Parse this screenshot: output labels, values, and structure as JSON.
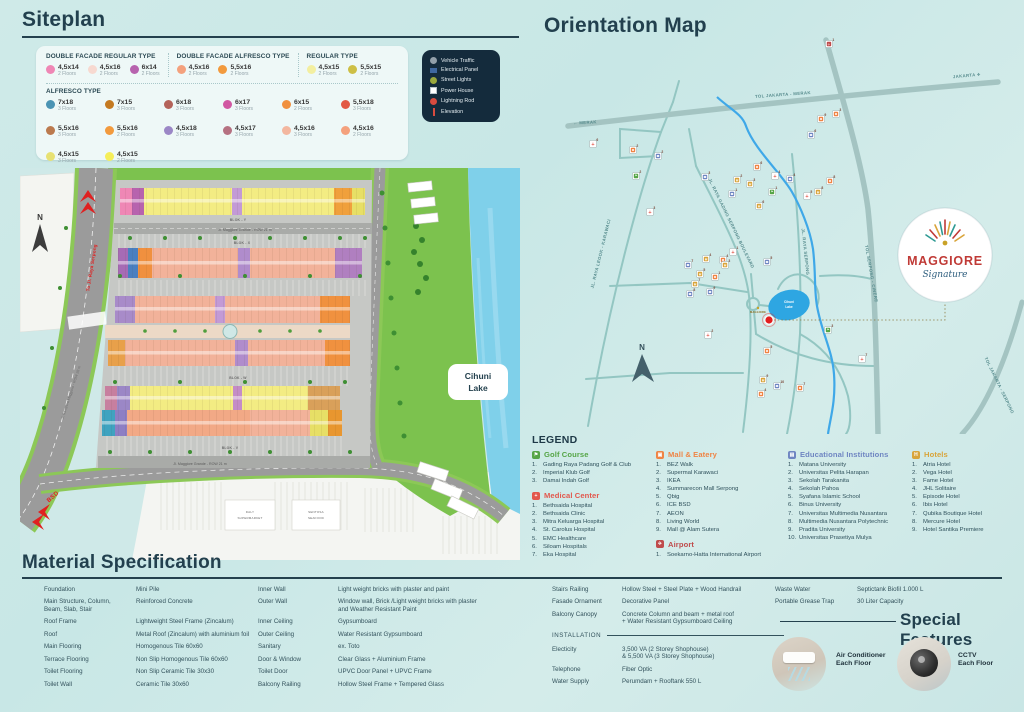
{
  "siteplan": {
    "title": "Siteplan",
    "facade_groups": [
      {
        "title": "DOUBLE FACADE REGULAR TYPE",
        "items": [
          {
            "size": "4,5x14",
            "floors": "2 Floors",
            "color": "#ef87b5"
          },
          {
            "size": "4,5x16",
            "floors": "2 Floors",
            "color": "#f7d9d0"
          },
          {
            "size": "6x14",
            "floors": "2 Floors",
            "color": "#b763ae"
          }
        ]
      },
      {
        "title": "DOUBLE FACADE ALFRESCO TYPE",
        "items": [
          {
            "size": "4,5x16",
            "floors": "2 Floors",
            "color": "#f4a17d"
          },
          {
            "size": "5,5x16",
            "floors": "2 Floors",
            "color": "#f29a3d"
          }
        ]
      },
      {
        "title": "REGULAR TYPE",
        "items": [
          {
            "size": "4,5x15",
            "floors": "2 Floors",
            "color": "#f3efa0"
          },
          {
            "size": "5,5x15",
            "floors": "2 Floors",
            "color": "#cdbf45"
          }
        ]
      }
    ],
    "alfresco": {
      "title": "ALFRESCO TYPE",
      "items": [
        {
          "size": "7x18",
          "floors": "3 Floors",
          "color": "#4b94b4"
        },
        {
          "size": "7x15",
          "floors": "3 Floors",
          "color": "#c47a21"
        },
        {
          "size": "6x18",
          "floors": "3 Floors",
          "color": "#b4635a"
        },
        {
          "size": "6x17",
          "floors": "3 Floors",
          "color": "#d158a2"
        },
        {
          "size": "6x15",
          "floors": "2 Floors",
          "color": "#f0903f"
        },
        {
          "size": "5,5x18",
          "floors": "3 Floors",
          "color": "#e25944"
        },
        {
          "size": "5,5x16",
          "floors": "3 Floors",
          "color": "#bb7a4e"
        },
        {
          "size": "5,5x16",
          "floors": "2 Floors",
          "color": "#f29a3d"
        },
        {
          "size": "4,5x18",
          "floors": "3 Floors",
          "color": "#9b87c6"
        },
        {
          "size": "4,5x17",
          "floors": "3 Floors",
          "color": "#b57181"
        },
        {
          "size": "4,5x16",
          "floors": "3 Floors",
          "color": "#f3b79f"
        },
        {
          "size": "4,5x16",
          "floors": "2 Floors",
          "color": "#f4a17d"
        },
        {
          "size": "4,5x15",
          "floors": "3 Floors",
          "color": "#e7e173"
        },
        {
          "size": "4,5x15",
          "floors": "2 Floors",
          "color": "#f5ee59"
        }
      ]
    },
    "map_legend": {
      "items": [
        {
          "label": "Vehicle Traffic",
          "icon": "vehicle"
        },
        {
          "label": "Electrical Panel",
          "icon": "panel"
        },
        {
          "label": "Street Lights",
          "icon": "light"
        },
        {
          "label": "Power House",
          "icon": "power"
        },
        {
          "label": "Lightning Rod",
          "icon": "rod"
        },
        {
          "label": "Elevation",
          "icon": "elevation"
        }
      ]
    },
    "map_labels": {
      "compass": "N",
      "to_serpong": "To Jl. Raya Serpong",
      "row28": "Jl. Sampora Maggiore - ROW 28 m",
      "bsd": "BSD",
      "street_top": "Jl. Maggiore Grande - ROW 21 m",
      "street_bottom": "Jl. Maggiore Grande - ROW 21 m",
      "blok_y": "BLOK - Y",
      "blok_x": "BLOK - X",
      "blok_w": "BLOK - W",
      "blok_v": "BLOK - V",
      "lake1": "Cihuni",
      "lake2": "Lake",
      "sm1": "DALY",
      "sm2": "SUPERMARKET",
      "sf1": "SENTOSA",
      "sf2": "SEAFOOD"
    }
  },
  "orientation": {
    "title": "Orientation Map",
    "compass": "N",
    "lake1": "Cihuni",
    "lake2": "Lake",
    "site_label": "MAGGIORE",
    "logo": {
      "name": "MAGGIORE",
      "tagline": "Signature"
    },
    "road_labels": [
      {
        "text": "TOL JAKARTA - MERAK",
        "x": 253,
        "y": 62,
        "rot": -4
      },
      {
        "text": "JAKARTA ✈",
        "x": 437,
        "y": 43,
        "rot": -5
      },
      {
        "text": "← MERAK",
        "x": 55,
        "y": 90,
        "rot": -3
      },
      {
        "text": "TOL SERPONG - CINERE",
        "x": 340,
        "y": 240,
        "rot": 80
      },
      {
        "text": "TOL JAKARTA - SERPONG",
        "x": 468,
        "y": 352,
        "rot": 64
      },
      {
        "text": "JL. RAYA SERPONG",
        "x": 274,
        "y": 218,
        "rot": 84
      },
      {
        "text": "JL. RAYA LEGOK - KARAWACI",
        "x": 72,
        "y": 220,
        "rot": -76
      },
      {
        "text": "JL. RAYA GADING SERPONG BOULEVARD",
        "x": 200,
        "y": 190,
        "rot": 64
      }
    ],
    "markers": [
      {
        "t": "medical",
        "n": "6",
        "x": 63,
        "y": 110
      },
      {
        "t": "mall",
        "n": "2",
        "x": 103,
        "y": 116
      },
      {
        "t": "edu",
        "n": "2",
        "x": 128,
        "y": 122
      },
      {
        "t": "golf",
        "n": "2",
        "x": 106,
        "y": 142
      },
      {
        "t": "edu",
        "n": "3",
        "x": 175,
        "y": 143
      },
      {
        "t": "mall",
        "n": "6",
        "x": 227,
        "y": 133
      },
      {
        "t": "hotel",
        "n": "2",
        "x": 207,
        "y": 146
      },
      {
        "t": "hotel",
        "n": "3",
        "x": 220,
        "y": 150
      },
      {
        "t": "medical",
        "n": "4",
        "x": 245,
        "y": 142
      },
      {
        "t": "edu",
        "n": "1",
        "x": 202,
        "y": 160
      },
      {
        "t": "golf",
        "n": "1",
        "x": 242,
        "y": 158
      },
      {
        "t": "hotel",
        "n": "6",
        "x": 229,
        "y": 172
      },
      {
        "t": "medical",
        "n": "3",
        "x": 120,
        "y": 178
      },
      {
        "t": "airport",
        "n": "1",
        "x": 299,
        "y": 10
      },
      {
        "t": "mall",
        "n": "9",
        "x": 291,
        "y": 85
      },
      {
        "t": "mall",
        "n": "3",
        "x": 306,
        "y": 80
      },
      {
        "t": "edu",
        "n": "6",
        "x": 281,
        "y": 101
      },
      {
        "t": "edu",
        "n": "4",
        "x": 260,
        "y": 145
      },
      {
        "t": "mall",
        "n": "8",
        "x": 300,
        "y": 147
      },
      {
        "t": "hotel",
        "n": "8",
        "x": 288,
        "y": 158
      },
      {
        "t": "medical",
        "n": "5",
        "x": 277,
        "y": 162
      },
      {
        "t": "hotel",
        "n": "4",
        "x": 176,
        "y": 225
      },
      {
        "t": "medical",
        "n": "1",
        "x": 203,
        "y": 218
      },
      {
        "t": "mall",
        "n": "4",
        "x": 193,
        "y": 226
      },
      {
        "t": "hotel",
        "n": "3",
        "x": 195,
        "y": 231
      },
      {
        "t": "edu",
        "n": "7",
        "x": 158,
        "y": 231
      },
      {
        "t": "hotel",
        "n": "5",
        "x": 170,
        "y": 240
      },
      {
        "t": "mall",
        "n": "1",
        "x": 185,
        "y": 243
      },
      {
        "t": "hotel",
        "n": "7",
        "x": 165,
        "y": 250
      },
      {
        "t": "edu",
        "n": "8",
        "x": 160,
        "y": 260
      },
      {
        "t": "edu",
        "n": "9",
        "x": 180,
        "y": 258
      },
      {
        "t": "edu",
        "n": "5",
        "x": 237,
        "y": 228
      },
      {
        "t": "medical",
        "n": "2",
        "x": 178,
        "y": 301
      },
      {
        "t": "mall",
        "n": "5",
        "x": 237,
        "y": 317
      },
      {
        "t": "golf",
        "n": "3",
        "x": 298,
        "y": 296
      },
      {
        "t": "medical",
        "n": "7",
        "x": 332,
        "y": 325
      },
      {
        "t": "hotel",
        "n": "9",
        "x": 233,
        "y": 346
      },
      {
        "t": "edu",
        "n": "10",
        "x": 247,
        "y": 352
      },
      {
        "t": "mall",
        "n": "7",
        "x": 270,
        "y": 354
      },
      {
        "t": "mall",
        "n": "4",
        "x": 231,
        "y": 360
      }
    ]
  },
  "legend": {
    "title": "LEGEND",
    "sections": [
      {
        "title": "Golf Course",
        "color": "#55a546",
        "glyph": "⚑",
        "items": [
          "Gading Raya Padang Golf & Club",
          "Imperial Klub Golf",
          "Damai Indah Golf"
        ]
      },
      {
        "title": "Medical Center",
        "color": "#e2574c",
        "glyph": "+",
        "items": [
          "Bethsaida Hospital",
          "Bethsaida Clinic",
          "Mitra Keluarga Hospital",
          "St. Carolus Hospital",
          "EMC Healthcare",
          "Siloam Hospitals",
          "Eka Hospital"
        ]
      },
      {
        "title": "Mall & Eatery",
        "color": "#ef8445",
        "glyph": "▣",
        "items": [
          "BEZ Walk",
          "Supermal Karawaci",
          "IKEA",
          "Summarecon Mall Serpong",
          "Qbig",
          "ICE BSD",
          "AEON",
          "Living World",
          "Mall @ Alam Sutera"
        ]
      },
      {
        "title": "Airport",
        "color": "#bf4b4b",
        "glyph": "✈",
        "items": [
          "Soekarno-Hatta International Airport"
        ]
      },
      {
        "title": "Educational Institutions",
        "color": "#6f86c2",
        "glyph": "▤",
        "items": [
          "Matana University",
          "Universitas Pelita Harapan",
          "Sekolah Tarakanita",
          "Sekolah Pahoa",
          "Syafana Islamic School",
          "Binus University",
          "Universitas Multimedia Nusantara",
          "Multimedia Nusantara Polytechnic",
          "Pradita University",
          "Universitas Prasetiya Mulya"
        ]
      },
      {
        "title": "Hotels",
        "color": "#d8a43a",
        "glyph": "H",
        "items": [
          "Atria Hotel",
          "Vega Hotel",
          "Fame Hotel",
          "JHL Solitaire",
          "Episode Hotel",
          "Ibis Hotel",
          "Qubika Boutique Hotel",
          "Mercure Hotel",
          "Hotel Santika Premiere"
        ]
      }
    ]
  },
  "materials": {
    "title": "Material Specification",
    "installation_label": "INSTALLATION",
    "g1": [
      {
        "k": "Foundation",
        "v": "Mini Pile"
      },
      {
        "k": "Main Structure, Column,\nBeam, Slab, Stair",
        "v": "Reinforced Concrete"
      },
      {
        "k": "Roof Frame",
        "v": "Lightweight Steel Frame (Zincalum)"
      },
      {
        "k": "Roof",
        "v": "Metal Roof (Zincalum) with aluminium foil"
      },
      {
        "k": "Main Flooring",
        "v": "Homogenous Tile 60x60"
      },
      {
        "k": "Terrace Flooring",
        "v": "Non Slip Homogenous Tile 60x60"
      },
      {
        "k": "Toilet Flooring",
        "v": "Non Slip Ceramic Tile 30x30"
      },
      {
        "k": "Toilet Wall",
        "v": "Ceramic Tile 30x60"
      }
    ],
    "g2": [
      {
        "k": "Inner Wall",
        "v": "Light weight bricks with plaster and paint"
      },
      {
        "k": "Outer Wall",
        "v": "Window wall, Brick /Light weight bricks with plaster\nand Weather Resistant Paint"
      },
      {
        "k": "Inner Ceiling",
        "v": "Gypsumboard"
      },
      {
        "k": "Outer Ceiling",
        "v": "Water Resistant Gypsumboard"
      },
      {
        "k": "Sanitary",
        "v": "ex. Toto"
      },
      {
        "k": "Door & Window",
        "v": "Clear Glass + Aluminium Frame"
      },
      {
        "k": "Toilet Door",
        "v": "UPVC Door Panel + UPVC Frame"
      },
      {
        "k": "Balcony Railing",
        "v": "Hollow Steel Frame + Tempered Glass"
      }
    ],
    "g3a": [
      {
        "k": "Stairs Railing",
        "v": "Hollow Steel + Steel Plate + Wood Handrail"
      },
      {
        "k": "Fasade Ornament",
        "v": "Decorative Panel"
      },
      {
        "k": "Balcony Canopy",
        "v": "Concrete Column and beam + metal roof\n+ Water Resistant Gypsumboard Ceiling"
      }
    ],
    "g3b": [
      {
        "k": "Electicity",
        "v": "3,500 VA (2 Storey Shophouse)\n& 5,500 VA (3 Storey Shophouse)"
      },
      {
        "k": "Telephone",
        "v": "Fiber Optic"
      },
      {
        "k": "Water Supply",
        "v": "Perumdam + Rooftank 550 L"
      }
    ],
    "g4": [
      {
        "k": "Waste Water",
        "v": "Septictank Biofil 1.000 L"
      },
      {
        "k": "Portable Grease Trap",
        "v": "30 Liter Capacity"
      }
    ]
  },
  "special": {
    "title": "Special Features",
    "ac_label": "Air Conditioner\nEach Floor",
    "cctv_label": "CCTV\nEach Floor"
  }
}
